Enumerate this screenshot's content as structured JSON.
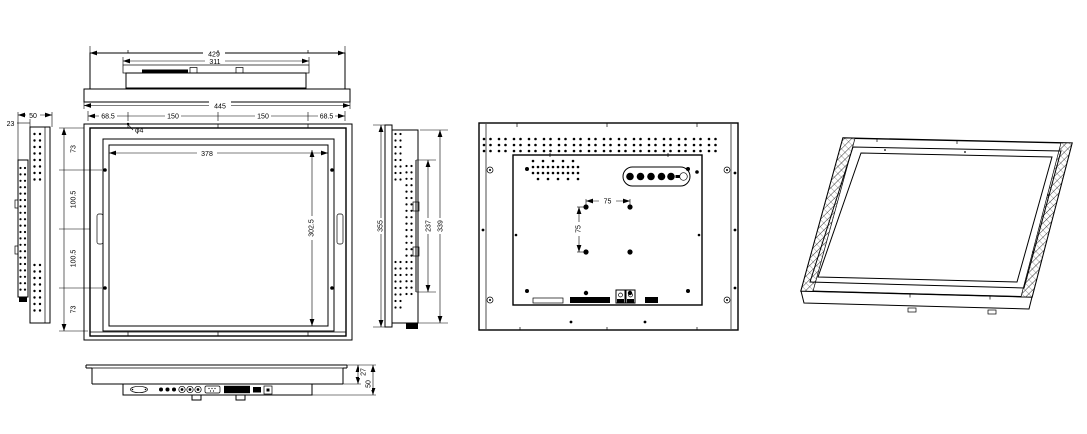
{
  "views": {
    "top": {
      "width_outer": "429",
      "width_module": "311",
      "width_base": "445"
    },
    "left_side": {
      "depth_total": "50",
      "depth_front": "23"
    },
    "front": {
      "mount_edge_left": "68.5",
      "mount_pitch_left": "150",
      "mount_pitch_right": "150",
      "mount_edge_right": "68.5",
      "mount_hole_dia": "φ4",
      "screen_width": "378",
      "screen_height": "302.5",
      "mount_top": "73",
      "mount_upper": "100.5",
      "mount_lower": "100.5",
      "mount_bottom": "73"
    },
    "right_side": {
      "height_total": "355",
      "bracket": "237",
      "chassis": "339"
    },
    "rear": {
      "vesa_width": "75",
      "vesa_height": "75"
    },
    "bottom": {
      "depth_rear": "27",
      "depth_total": "50"
    }
  }
}
